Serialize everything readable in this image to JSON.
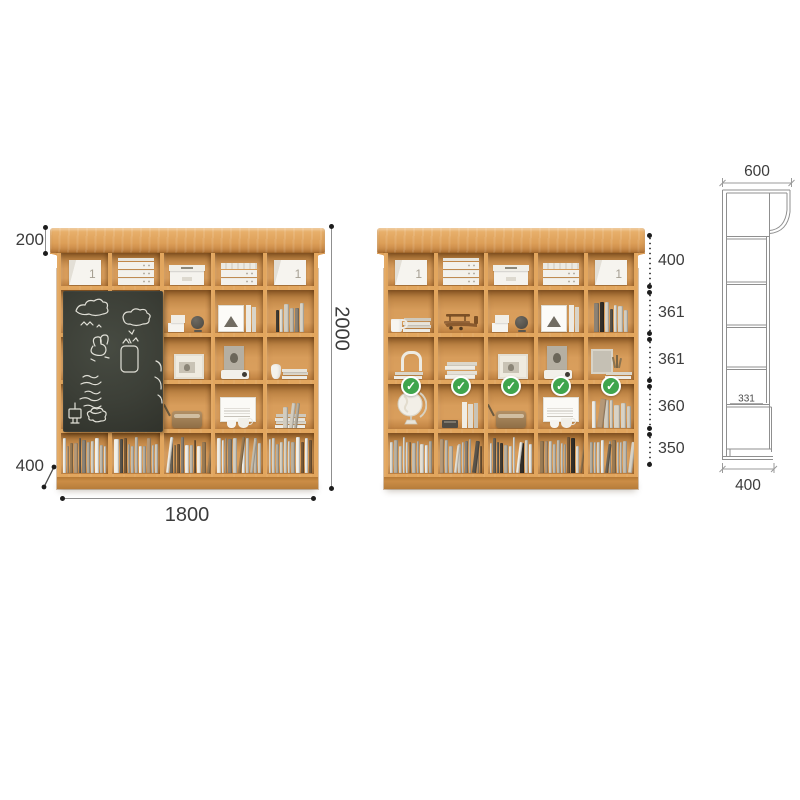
{
  "title": "bookshelf-dimension-diagram",
  "colors": {
    "wood_hi": "#ecb571",
    "wood_mid": "#dd9f58",
    "wood_lo": "#c08040",
    "wood_front": "#e2a65e",
    "interior_hi": "#d89d5b",
    "interior_lo": "#aa7134",
    "base": "#cb8d46",
    "chalkboard": "#3c3f37",
    "chalk": "#eeede4",
    "check_green": "#3fa54d",
    "dim_text": "#3c3c3c",
    "dim_line": "#8f8f8f",
    "dot": "#1d1d1d"
  },
  "front_left_view": {
    "dims": {
      "crown_height": "200",
      "bottom_depth": "400",
      "total_height": "2000",
      "total_width": "1800"
    },
    "box_label": "1",
    "rows": [
      [
        "box-single",
        "box-drawers",
        "box-lid",
        "box-drawers2",
        "box-single"
      ],
      [
        null,
        null,
        "cards-globe",
        "frame-triangle-books",
        "books-dark"
      ],
      [
        null,
        null,
        "photo-frame",
        "portrait-projector",
        "vase-books"
      ],
      [
        null,
        null,
        "radio",
        "art-cups",
        "books-flat"
      ],
      [
        "books-row-1",
        "books-row-2",
        "books-row-3",
        "books-row-4",
        "books-row-5"
      ]
    ],
    "chalkboard": true,
    "chalk_doodles": [
      "cloud",
      "cloud",
      "bunny",
      "jar",
      "chalk-text",
      "tv",
      "scribble"
    ]
  },
  "front_right_view": {
    "box_label": "1",
    "segment_dims": [
      "400",
      "361",
      "361",
      "360",
      "350"
    ],
    "rows": [
      [
        "box-single",
        "box-drawers",
        "box-lid",
        "box-drawers2",
        "box-single"
      ],
      [
        "mug-books",
        "toy-plane",
        "cards-globe",
        "frame-triangle-books",
        "books-mixed"
      ],
      [
        "arch-books",
        "book-stack",
        "photo-frame",
        "portrait-projector",
        "frame-plant-books"
      ],
      [
        "globe",
        "typewriter-books",
        "radio",
        "art-cups",
        "books-vertical"
      ],
      [
        "books-row-6",
        "books-row-7",
        "books-row-8",
        "books-row-9",
        "books-row-10"
      ]
    ],
    "checkmarks": 5,
    "checkmark_glyph": "✓"
  },
  "side_view": {
    "dims": {
      "top_depth": "600",
      "shelf_depth": "331",
      "bottom_depth": "400"
    }
  }
}
